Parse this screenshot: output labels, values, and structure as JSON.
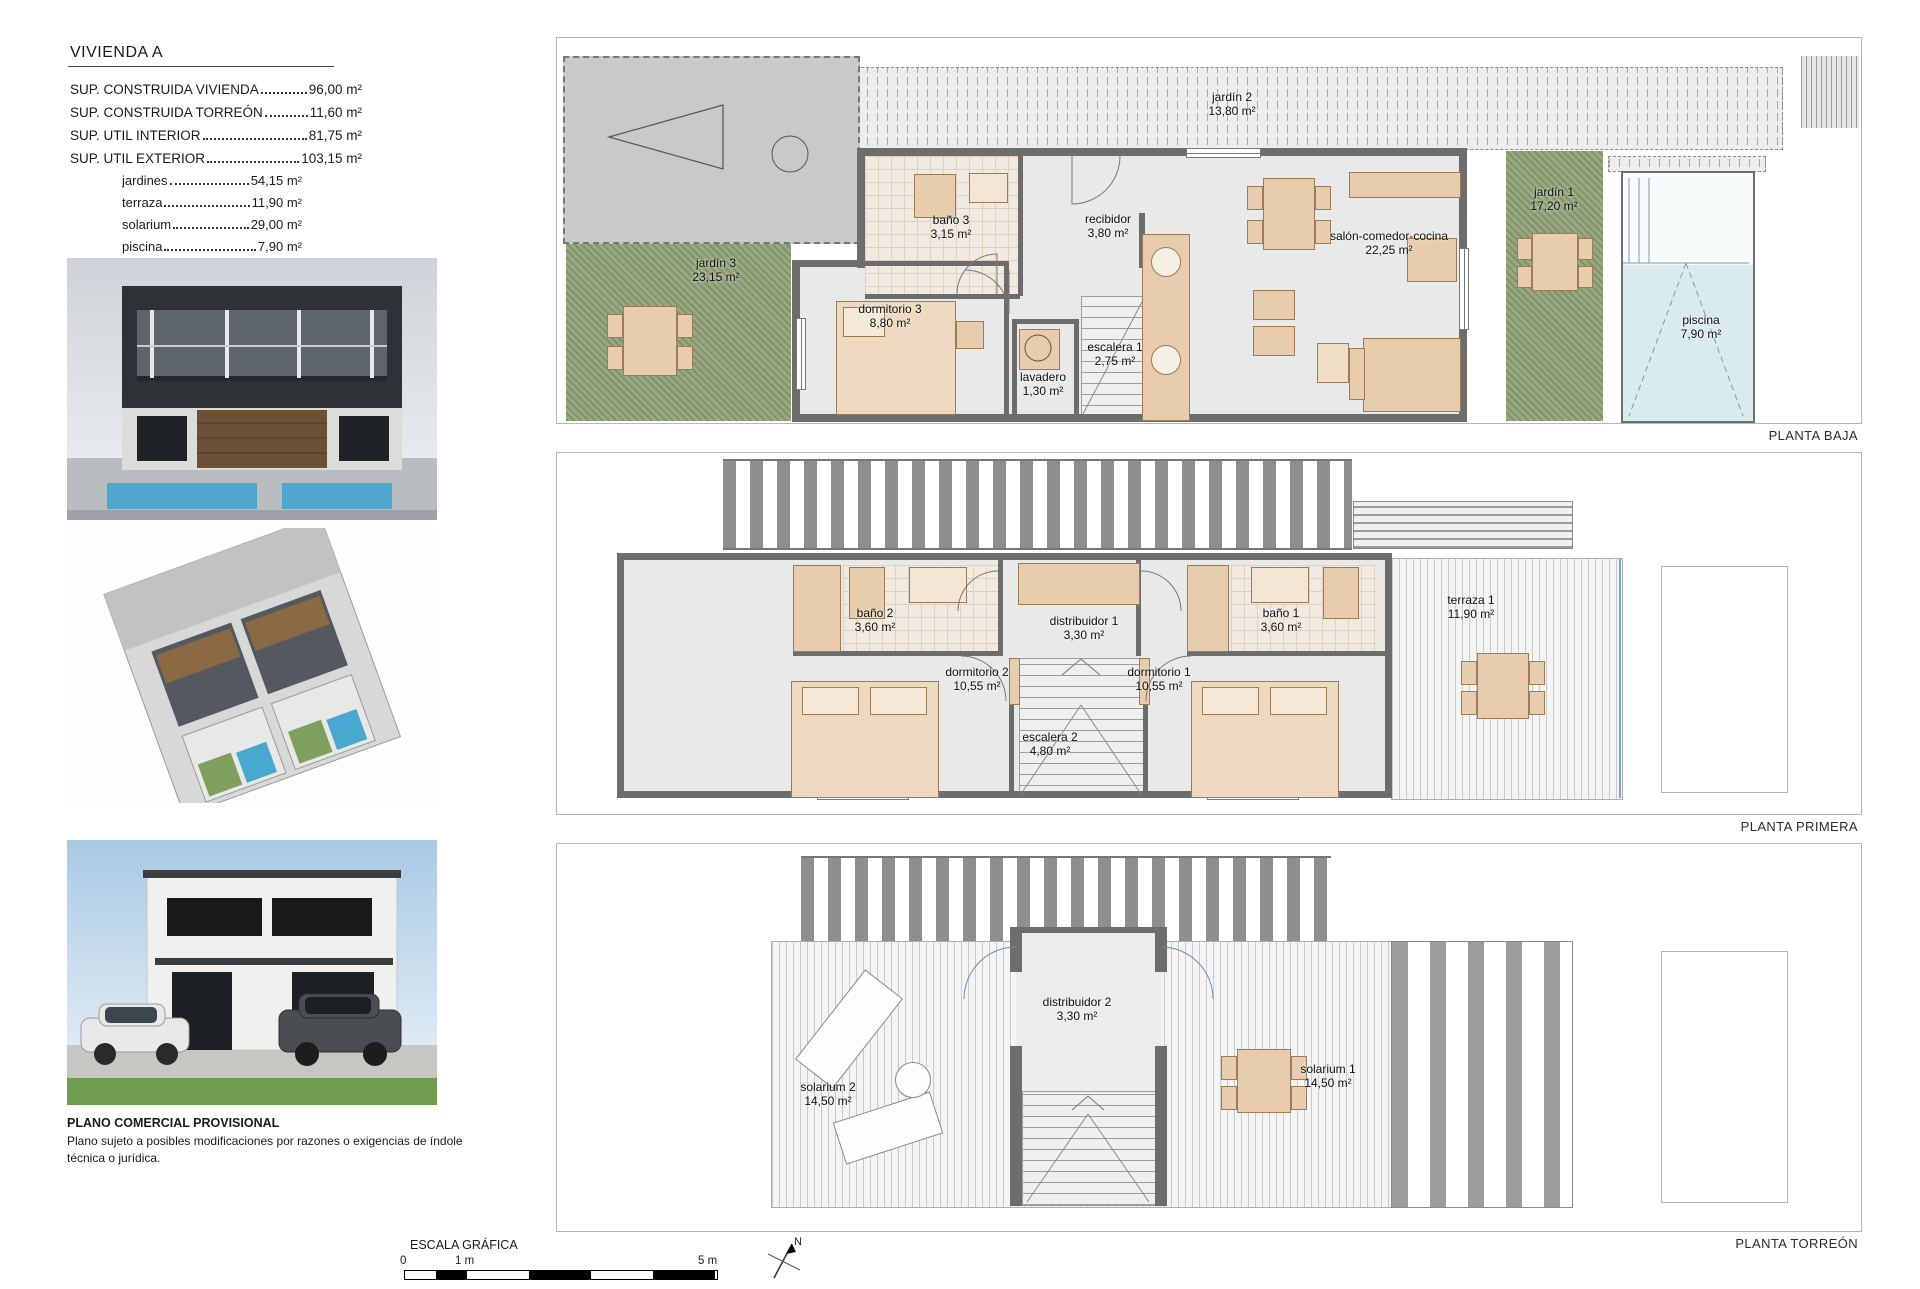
{
  "info_panel": {
    "title": "VIVIENDA A",
    "rows": [
      {
        "label": "SUP. CONSTRUIDA VIVIENDA",
        "value": "96,00 m²"
      },
      {
        "label": "SUP. CONSTRUIDA TORREÓN",
        "value": "11,60 m²"
      },
      {
        "label": "SUP. UTIL INTERIOR",
        "value": "81,75 m²"
      },
      {
        "label": "SUP. UTIL EXTERIOR",
        "value": "103,15 m²"
      }
    ],
    "sub_rows": [
      {
        "label": "jardines",
        "value": "54,15 m²"
      },
      {
        "label": "terraza",
        "value": "11,90 m²"
      },
      {
        "label": "solarium",
        "value": "29,00 m²"
      },
      {
        "label": "piscina",
        "value": "7,90 m²"
      }
    ]
  },
  "disclaimer": {
    "title": "PLANO COMERCIAL PROVISIONAL",
    "body": "Plano sujeto a posibles modificaciones por razones o exigencias de índole técnica o jurídica."
  },
  "plans": [
    {
      "label": "PLANTA BAJA",
      "rooms": [
        {
          "label": "jardín 2",
          "area": "13,80 m²"
        },
        {
          "label": "jardín 3",
          "area": "23,15 m²"
        },
        {
          "label": "baño 3",
          "area": "3,15 m²"
        },
        {
          "label": "recibidor",
          "area": "3,80 m²"
        },
        {
          "label": "salón-comedor-cocina",
          "area": "22,25 m²"
        },
        {
          "label": "jardín 1",
          "area": "17,20 m²"
        },
        {
          "label": "dormitorio 3",
          "area": "8,80 m²"
        },
        {
          "label": "lavadero",
          "area": "1,30 m²"
        },
        {
          "label": "escalera 1",
          "area": "2,75 m²"
        },
        {
          "label": "piscina",
          "area": "7,90 m²"
        }
      ]
    },
    {
      "label": "PLANTA PRIMERA",
      "rooms": [
        {
          "label": "baño 2",
          "area": "3,60 m²"
        },
        {
          "label": "distribuidor 1",
          "area": "3,30 m²"
        },
        {
          "label": "baño 1",
          "area": "3,60 m²"
        },
        {
          "label": "terraza 1",
          "area": "11,90 m²"
        },
        {
          "label": "dormitorio 2",
          "area": "10,55 m²"
        },
        {
          "label": "dormitorio 1",
          "area": "10,55 m²"
        },
        {
          "label": "escalera 2",
          "area": "4,80 m²"
        }
      ]
    },
    {
      "label": "PLANTA TORREÓN",
      "rooms": [
        {
          "label": "solarium 2",
          "area": "14,50 m²"
        },
        {
          "label": "distribuidor 2",
          "area": "3,30 m²"
        },
        {
          "label": "solarium 1",
          "area": "14,50 m²"
        }
      ]
    }
  ],
  "scale_bar": {
    "title": "ESCALA GRÁFICA",
    "tick_zero": "0",
    "tick_one": "1 m",
    "tick_five": "5 m"
  },
  "north": {
    "label": "N"
  },
  "colors": {
    "wall": "#6d6d6d",
    "garden": "#98a983",
    "pool": "#d9ebee",
    "furniture": "#e7cdad"
  }
}
